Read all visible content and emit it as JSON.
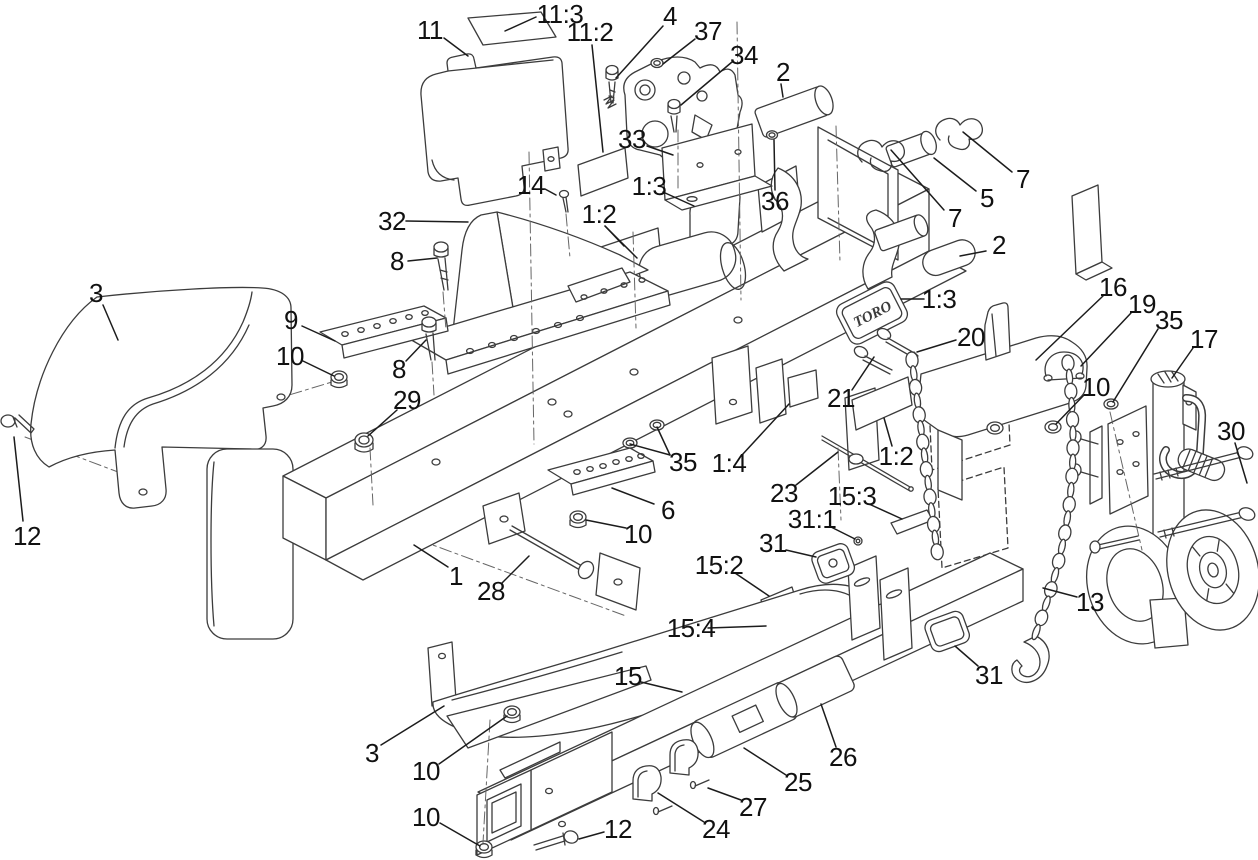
{
  "figure": {
    "kind": "exploded-parts-diagram",
    "brand_text": "TORO",
    "background": "#ffffff",
    "line_color": "#3c3c3c",
    "label_color": "#111111"
  },
  "callouts": [
    {
      "label": "11:3",
      "x": 560,
      "y": 14,
      "leaders": [
        [
          536,
          17,
          505,
          31
        ]
      ]
    },
    {
      "label": "11",
      "x": 430,
      "y": 30,
      "leaders": [
        [
          444,
          38,
          468,
          56
        ]
      ]
    },
    {
      "label": "11:2",
      "x": 590,
      "y": 32,
      "leaders": [
        [
          592,
          45,
          603,
          152
        ]
      ]
    },
    {
      "label": "4",
      "x": 670,
      "y": 16,
      "leaders": [
        [
          663,
          26,
          616,
          78
        ]
      ]
    },
    {
      "label": "37",
      "x": 708,
      "y": 31,
      "leaders": [
        [
          695,
          39,
          663,
          64
        ]
      ]
    },
    {
      "label": "34",
      "x": 744,
      "y": 55,
      "leaders": [
        [
          732,
          62,
          681,
          105
        ]
      ]
    },
    {
      "label": "2",
      "x": 783,
      "y": 72,
      "leaders": [
        [
          781,
          84,
          783,
          97
        ]
      ]
    },
    {
      "label": "33",
      "x": 632,
      "y": 139,
      "leaders": [
        [
          647,
          146,
          673,
          155
        ]
      ]
    },
    {
      "label": "36",
      "x": 775,
      "y": 201,
      "leaders": [
        [
          775,
          190,
          774,
          140
        ]
      ]
    },
    {
      "label": "14",
      "x": 531,
      "y": 185,
      "leaders": [
        [
          545,
          189,
          556,
          195
        ]
      ]
    },
    {
      "label": "1:3",
      "x": 649,
      "y": 186,
      "leaders": [
        [
          663,
          192,
          694,
          206
        ]
      ]
    },
    {
      "label": "1:2",
      "x": 599,
      "y": 214,
      "leaders": [
        [
          605,
          226,
          624,
          246
        ],
        [
          605,
          226,
          637,
          258
        ]
      ]
    },
    {
      "label": "32",
      "x": 392,
      "y": 221,
      "leaders": [
        [
          406,
          221,
          468,
          222
        ]
      ]
    },
    {
      "label": "8",
      "x": 397,
      "y": 261,
      "leaders": [
        [
          408,
          261,
          437,
          258
        ]
      ]
    },
    {
      "label": "2",
      "x": 999,
      "y": 245,
      "leaders": [
        [
          986,
          251,
          960,
          256
        ]
      ]
    },
    {
      "label": "3",
      "x": 96,
      "y": 293,
      "leaders": [
        [
          103,
          305,
          118,
          340
        ]
      ]
    },
    {
      "label": "9",
      "x": 291,
      "y": 320,
      "leaders": [
        [
          302,
          326,
          335,
          341
        ]
      ]
    },
    {
      "label": "10",
      "x": 290,
      "y": 356,
      "leaders": [
        [
          303,
          361,
          334,
          376
        ]
      ]
    },
    {
      "label": "8",
      "x": 399,
      "y": 369,
      "leaders": [
        [
          406,
          361,
          426,
          340
        ]
      ]
    },
    {
      "label": "29",
      "x": 407,
      "y": 400,
      "leaders": [
        [
          397,
          410,
          368,
          436
        ]
      ]
    },
    {
      "label": "1:3",
      "x": 939,
      "y": 299,
      "leaders": [
        [
          924,
          299,
          901,
          299
        ]
      ]
    },
    {
      "label": "16",
      "x": 1113,
      "y": 287,
      "leaders": [
        [
          1103,
          296,
          1036,
          360
        ]
      ]
    },
    {
      "label": "19",
      "x": 1142,
      "y": 304,
      "leaders": [
        [
          1131,
          313,
          1081,
          366
        ]
      ]
    },
    {
      "label": "35",
      "x": 1169,
      "y": 320,
      "leaders": [
        [
          1158,
          329,
          1113,
          402
        ]
      ]
    },
    {
      "label": "17",
      "x": 1204,
      "y": 339,
      "leaders": [
        [
          1193,
          348,
          1172,
          378
        ]
      ]
    },
    {
      "label": "10",
      "x": 1096,
      "y": 387,
      "leaders": [
        [
          1084,
          395,
          1056,
          424
        ]
      ]
    },
    {
      "label": "30",
      "x": 1231,
      "y": 431,
      "leaders": [
        [
          1235,
          443,
          1247,
          483
        ]
      ]
    },
    {
      "label": "20",
      "x": 971,
      "y": 337,
      "leaders": [
        [
          956,
          340,
          917,
          352
        ]
      ]
    },
    {
      "label": "21",
      "x": 841,
      "y": 398,
      "leaders": [
        [
          852,
          390,
          874,
          357
        ]
      ]
    },
    {
      "label": "1:2",
      "x": 896,
      "y": 456,
      "leaders": [
        [
          892,
          446,
          884,
          418
        ]
      ]
    },
    {
      "label": "1:4",
      "x": 729,
      "y": 463,
      "leaders": [
        [
          742,
          455,
          789,
          404
        ]
      ]
    },
    {
      "label": "35",
      "x": 683,
      "y": 462,
      "leaders": [
        [
          670,
          455,
          630,
          444
        ],
        [
          670,
          455,
          657,
          427
        ]
      ]
    },
    {
      "label": "23",
      "x": 784,
      "y": 493,
      "leaders": [
        [
          796,
          485,
          838,
          452
        ]
      ]
    },
    {
      "label": "15:3",
      "x": 852,
      "y": 496,
      "leaders": [
        [
          869,
          504,
          902,
          519
        ]
      ]
    },
    {
      "label": "31:1",
      "x": 812,
      "y": 519,
      "leaders": [
        [
          831,
          527,
          855,
          539
        ]
      ]
    },
    {
      "label": "31",
      "x": 773,
      "y": 543,
      "leaders": [
        [
          786,
          550,
          816,
          557
        ]
      ]
    },
    {
      "label": "15:2",
      "x": 719,
      "y": 565,
      "leaders": [
        [
          735,
          573,
          769,
          596
        ]
      ]
    },
    {
      "label": "6",
      "x": 668,
      "y": 510,
      "leaders": [
        [
          654,
          504,
          612,
          488
        ]
      ]
    },
    {
      "label": "10",
      "x": 638,
      "y": 534,
      "leaders": [
        [
          626,
          528,
          586,
          520
        ]
      ]
    },
    {
      "label": "1",
      "x": 456,
      "y": 576,
      "leaders": [
        [
          448,
          567,
          414,
          545
        ]
      ]
    },
    {
      "label": "28",
      "x": 491,
      "y": 591,
      "leaders": [
        [
          502,
          583,
          529,
          556
        ]
      ]
    },
    {
      "label": "15:4",
      "x": 691,
      "y": 628,
      "leaders": [
        [
          708,
          628,
          766,
          626
        ]
      ]
    },
    {
      "label": "13",
      "x": 1090,
      "y": 602,
      "leaders": [
        [
          1077,
          597,
          1043,
          588
        ]
      ]
    },
    {
      "label": "31",
      "x": 989,
      "y": 675,
      "leaders": [
        [
          978,
          666,
          955,
          646
        ]
      ]
    },
    {
      "label": "15",
      "x": 628,
      "y": 676,
      "leaders": [
        [
          641,
          682,
          682,
          692
        ]
      ]
    },
    {
      "label": "26",
      "x": 843,
      "y": 757,
      "leaders": [
        [
          836,
          747,
          821,
          704
        ]
      ]
    },
    {
      "label": "25",
      "x": 798,
      "y": 782,
      "leaders": [
        [
          786,
          775,
          744,
          748
        ]
      ]
    },
    {
      "label": "3",
      "x": 372,
      "y": 753,
      "leaders": [
        [
          381,
          745,
          444,
          706
        ]
      ]
    },
    {
      "label": "10",
      "x": 426,
      "y": 771,
      "leaders": [
        [
          439,
          764,
          507,
          716
        ]
      ]
    },
    {
      "label": "27",
      "x": 753,
      "y": 807,
      "leaders": [
        [
          741,
          800,
          708,
          788
        ]
      ]
    },
    {
      "label": "24",
      "x": 716,
      "y": 829,
      "leaders": [
        [
          704,
          822,
          658,
          793
        ]
      ]
    },
    {
      "label": "12",
      "x": 618,
      "y": 829,
      "leaders": [
        [
          604,
          832,
          579,
          839
        ]
      ]
    },
    {
      "label": "10",
      "x": 426,
      "y": 817,
      "leaders": [
        [
          440,
          823,
          480,
          846
        ]
      ]
    },
    {
      "label": "12",
      "x": 27,
      "y": 536,
      "leaders": [
        [
          23,
          521,
          14,
          437
        ]
      ]
    },
    {
      "label": "7",
      "x": 955,
      "y": 218,
      "leaders": [
        [
          944,
          210,
          891,
          150
        ]
      ]
    },
    {
      "label": "5",
      "x": 987,
      "y": 198,
      "leaders": [
        [
          976,
          191,
          934,
          158
        ]
      ]
    },
    {
      "label": "7",
      "x": 1023,
      "y": 179,
      "leaders": [
        [
          1012,
          172,
          963,
          132
        ]
      ]
    }
  ]
}
